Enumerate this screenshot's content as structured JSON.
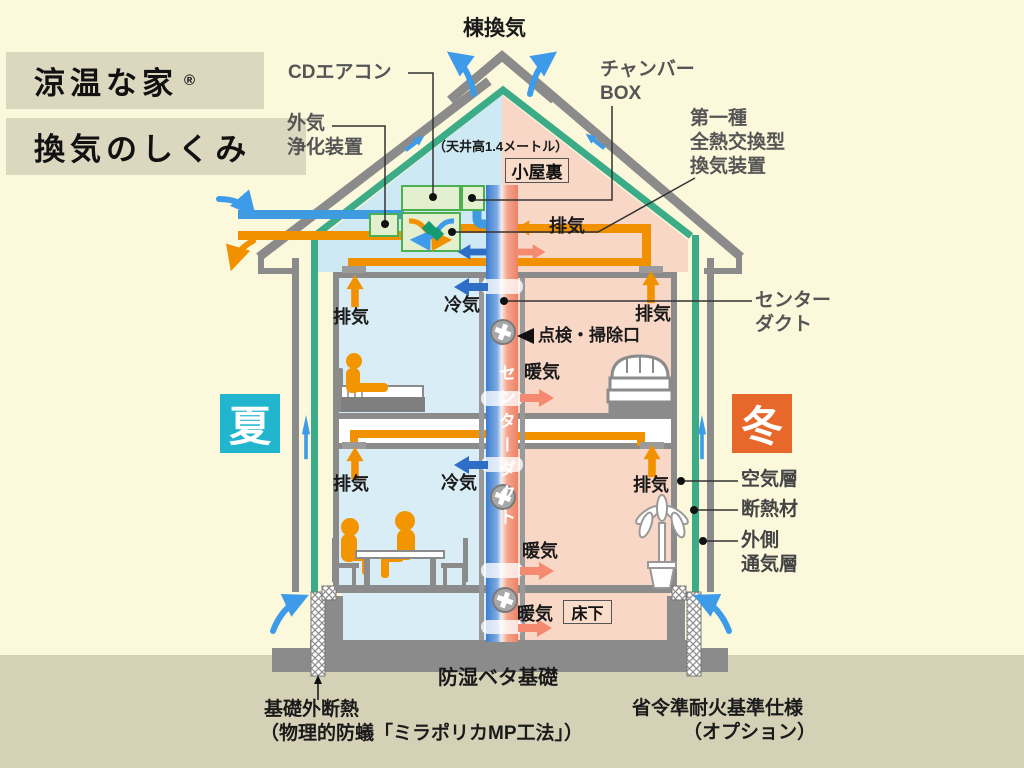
{
  "title": {
    "line1": "涼温な家",
    "reg": "®",
    "line2": "換気のしくみ"
  },
  "top": {
    "ridge_vent": "棟換気",
    "ceiling_height": "（天井高1.4メートル）",
    "attic": "小屋裏"
  },
  "equipment": {
    "cd_aircon": "CDエアコン",
    "purifier_l1": "外気",
    "purifier_l2": "浄化装置",
    "chamber_l1": "チャンバー",
    "chamber_l2": "BOX",
    "hx_l1": "第一種",
    "hx_l2": "全熱交換型",
    "hx_l3": "換気装置"
  },
  "flows": {
    "exhaust": "排気",
    "cool": "冷気",
    "warm": "暖気"
  },
  "duct": {
    "label_l1": "センター",
    "label_l2": "ダクト",
    "vertical": "センターダクト",
    "inspection": "点検・掃除口"
  },
  "seasons": {
    "summer": "夏",
    "winter": "冬"
  },
  "wall": {
    "air_layer": "空気層",
    "insulation": "断熱材",
    "outer_vent_l1": "外側",
    "outer_vent_l2": "通気層"
  },
  "bottom": {
    "underfloor": "床下",
    "foundation": "防湿ベタ基礎",
    "base_insulation": "基礎外断熱",
    "base_insulation_sub": "（物理的防蟻「ミラポリカMP工法」）",
    "fire_spec": "省令準耐火基準仕様",
    "fire_spec_sub": "（オプション）"
  },
  "colors": {
    "background": "#FBF8DB",
    "ground": "#D5D1B6",
    "title_box": "#DBD8BF",
    "summer_badge": "#21B6CE",
    "winter_badge": "#E8682C",
    "room_blue": "#D9EDF6",
    "room_pink": "#F8D7C6",
    "wall_green": "#3CAB87",
    "structure_gray": "#8B8B8B",
    "duct_orange": "#F29100",
    "duct_blue": "#3E9BE0",
    "center_duct_blue": "#3B7CD0",
    "center_duct_red": "#EE8166",
    "arrow_sky": "#3D9BE9",
    "arrow_cool": "#2E6EC6",
    "arrow_warm": "#F58A70",
    "equipment_fill": "#E3F0CF",
    "equipment_border": "#4CAF50"
  }
}
